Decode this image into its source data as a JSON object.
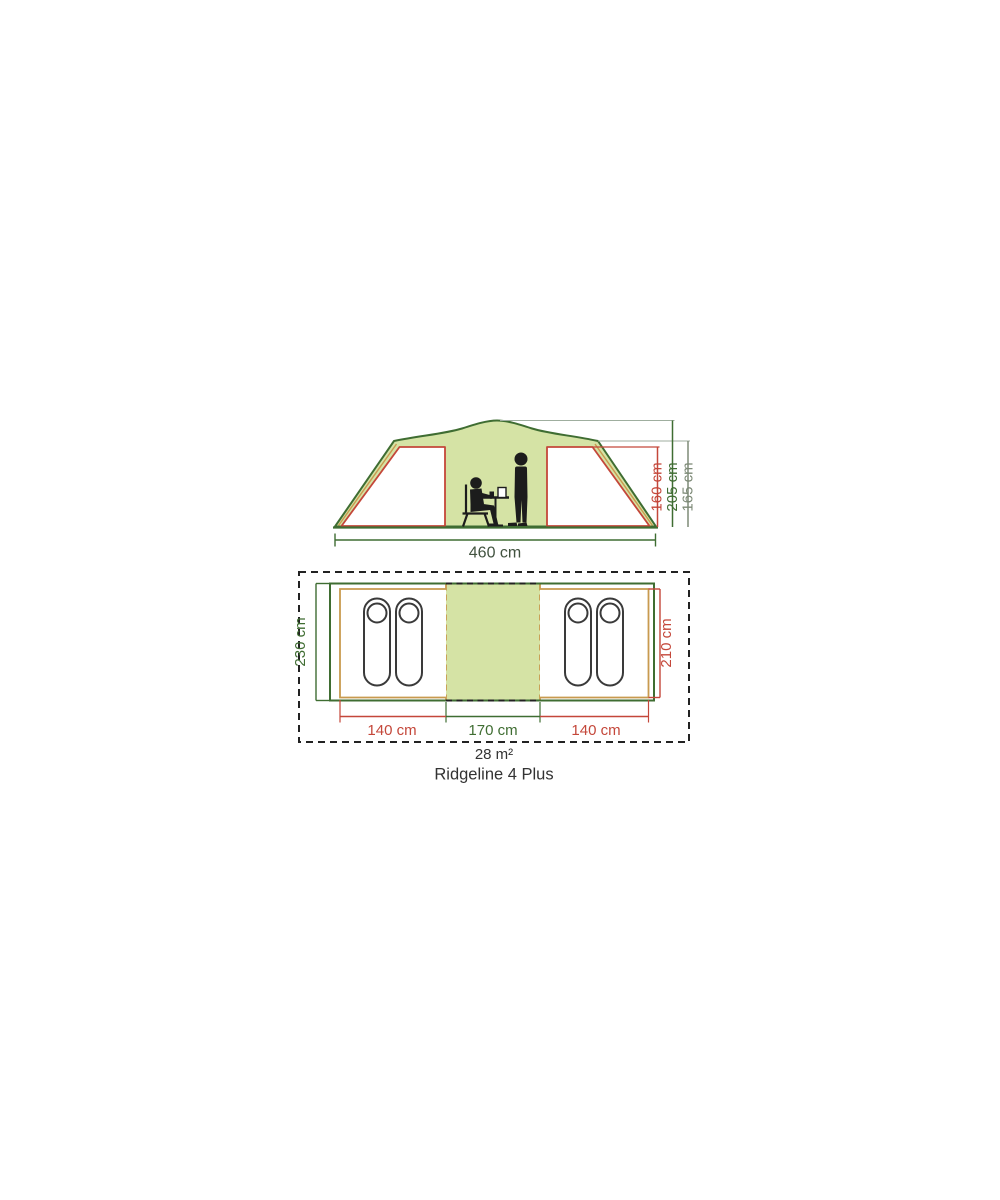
{
  "diagram": {
    "product_name": "Ridgeline 4 Plus",
    "footprint_area": "28 m²",
    "elevation": {
      "total_width": "460 cm",
      "bedroom_height": "160 cm",
      "peak_height": "205 cm",
      "shoulder_height": "165 cm"
    },
    "floorplan": {
      "outer_depth": "230 cm",
      "bedroom_depth": "210 cm",
      "left_bedroom_width": "140 cm",
      "living_area_width": "170 cm",
      "right_bedroom_width": "140 cm"
    },
    "colors": {
      "tent_outline_green": "#3f6d32",
      "canvas_light_green": "#d5e3a5",
      "inner_tent_red": "#c4473a",
      "groundsheet_tan": "#c89a4f",
      "shoulder_dim_gray": "#7d8a77",
      "footprint_dash_black": "#222222",
      "text_dark": "#333333"
    }
  }
}
